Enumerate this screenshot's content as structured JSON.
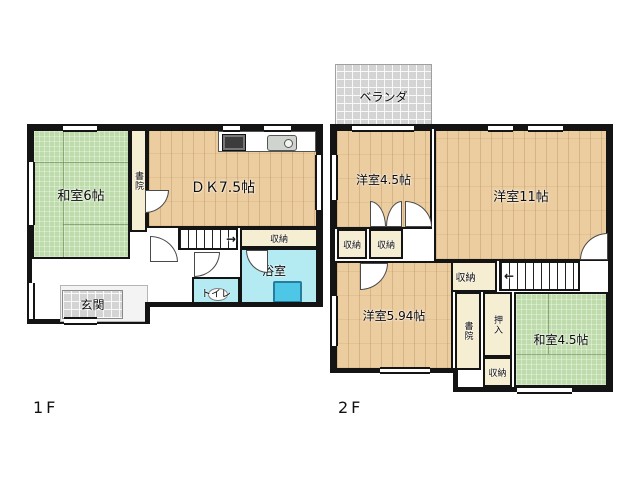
{
  "floors": {
    "f1": {
      "floor_label": "1F",
      "rooms": {
        "washitsu6": "和室6帖",
        "shoin": "書院",
        "dk": "ＤＫ7.5帖",
        "closet": "収納",
        "bathroom": "浴室",
        "toilet": "トイレ",
        "genkan": "玄関"
      }
    },
    "f2": {
      "floor_label": "2F",
      "rooms": {
        "veranda": "ベランダ",
        "yoshitsu45": "洋室4.5帖",
        "yoshitsu11": "洋室11帖",
        "closet_a": "収納",
        "closet_b": "収納",
        "closet_mid": "収納",
        "yoshitsu594": "洋室5.94帖",
        "shoin": "書院",
        "oshiire": "押入",
        "washitsu45": "和室4.5帖",
        "closet_bottom": "収納"
      }
    }
  },
  "icons": {
    "stairs_up_arrow": "→",
    "stairs_down_arrow": "←"
  },
  "colors": {
    "wall": "#141414",
    "tatami_green": "#bedcab",
    "wood_tan": "#eccda0",
    "closet_cream": "#f6eed2",
    "water_cyan": "#b4eaf2",
    "bathtub_blue": "#4ec7e6",
    "tile_gray": "#d4d4d4"
  }
}
